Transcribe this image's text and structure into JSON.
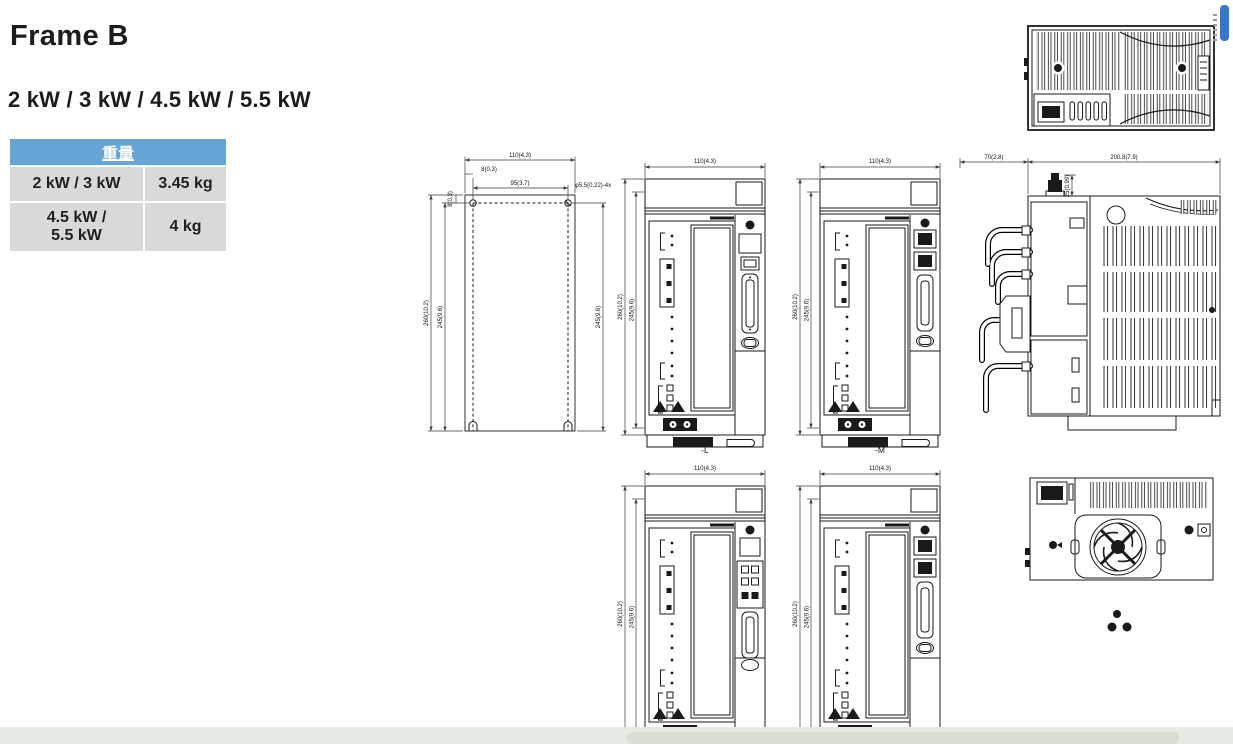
{
  "page": {
    "title": "Frame B",
    "subtitle": "2 kW / 3 kW / 4.5 kW / 5.5 kW"
  },
  "weight_table": {
    "header": "重量",
    "rows": [
      {
        "model": "2 kW / 3 kW",
        "weight": "3.45 kg"
      },
      {
        "model": "4.5 kW / 5.5 kW",
        "weight": "4 kg"
      }
    ]
  },
  "colors": {
    "table_header_bg": "#68a5d7",
    "table_cell_bg": "#d9d9d9",
    "footer_bar": "#e5eae2",
    "watermark_blue": "#3b76c4",
    "line_color": "#1a1a1a"
  },
  "drawings": {
    "mounting_plate": {
      "dim_width": "110(4.3)",
      "dim_top_offset": "8(0.3)",
      "dim_hole_spacing": "95(3.7)",
      "dim_left_offset": "8(0.3)",
      "hole_note": "φ5.5(0.22)-4x",
      "dim_height": "260(10.2)",
      "dim_hole_pitch_left": "245(9.6)",
      "dim_hole_pitch_right": "245(9.6)"
    },
    "front_view_l": {
      "dim_width": "110(4.3)",
      "dim_height": "260(10.2)",
      "dim_inner_height": "245(9.6)",
      "label": "-L"
    },
    "front_view_m": {
      "dim_width": "110(4.3)",
      "dim_height": "260(10.2)",
      "dim_inner_height": "245(9.6)",
      "label": "-M"
    },
    "side_view": {
      "dim_front_depth": "70(2.8)",
      "dim_body_depth": "200.8(7.9)",
      "dim_knob_height": "25(0.99)"
    },
    "front_view_bottom_left": {
      "dim_width": "110(4.3)",
      "dim_height": "260(10.2)",
      "dim_inner_height": "245(9.6)"
    },
    "front_view_bottom_right": {
      "dim_width": "110(4.3)",
      "dim_height": "260(10.2)",
      "dim_inner_height": "245(9.6)"
    }
  }
}
